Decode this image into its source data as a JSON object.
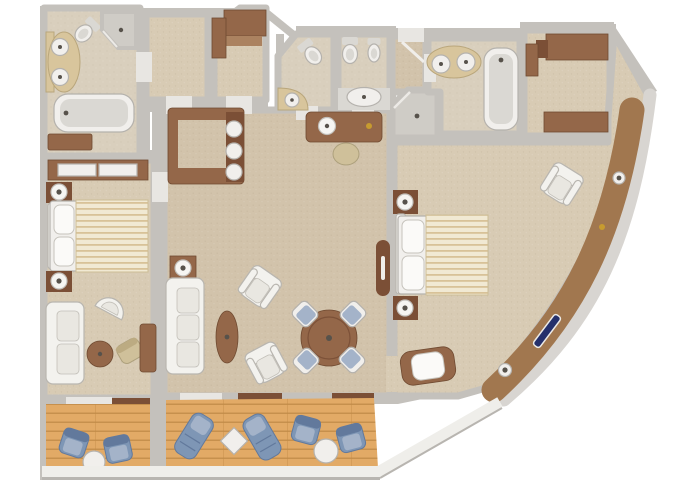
{
  "document": {
    "type": "floor-plan",
    "description": "Top-down 3D rendered floor plan of a two-bedroom ship suite with curved hull wall and two balconies",
    "visible_text": []
  },
  "colors": {
    "wall": "#c4c1bc",
    "hull": "#d8d5d1",
    "band": "#a1774f",
    "carpetLiving": "#d2c3ab",
    "carpetBedroom": "#d8cbb4",
    "bathFloor": "#d9cfbd",
    "showerTile": "#cfccc6",
    "deckWood": "#e2aa66",
    "deckLine": "#c08a47",
    "furnBrown": "#946749",
    "furnBrownDark": "#7b4f36",
    "furnBrownLight": "#ab8260",
    "counterTan": "#d8c59c",
    "fixtureWhite": "#f1efec",
    "fixtureInner": "#dad8d3",
    "fixtureEdge": "#b5b2ad",
    "sofaWhite": "#f3f2ee",
    "cushion": "#e9e7e1",
    "pillowWhite": "#fbfaf8",
    "duvetBase": "#f1e9d3",
    "duvetStripe": "#d8c298",
    "blue": "#7e96b5",
    "blueDark": "#62799c",
    "blueLight": "#a4b3c9",
    "windowNavy": "#25306b",
    "gold": "#c79b2f",
    "railing": "#efeeea",
    "lampWhite": "#f6f5f2",
    "stoolTan": "#cfc09a"
  },
  "rooms": [
    {
      "id": "master-bathroom",
      "fixtures": [
        "double-sink-vanity",
        "angled-toilet",
        "corner-shower",
        "bathtub",
        "storage-bench"
      ]
    },
    {
      "id": "wardrobe-room-a",
      "fixtures": []
    },
    {
      "id": "wardrobe-room-b",
      "fixtures": [
        "l-shaped-wardrobe"
      ]
    },
    {
      "id": "guest-toilet-1",
      "fixtures": [
        "angled-toilet",
        "corner-washbasin"
      ]
    },
    {
      "id": "guest-toilet-2",
      "fixtures": [
        "toilet",
        "bidet",
        "oval-washbasin"
      ]
    },
    {
      "id": "shower-room",
      "fixtures": [
        "corner-shower"
      ]
    },
    {
      "id": "second-bathroom",
      "fixtures": [
        "double-sink-vanity",
        "bathtub"
      ]
    },
    {
      "id": "walk-in-closet",
      "fixtures": [
        "wardrobe-top",
        "wardrobe-bottom",
        "side-cabinet"
      ]
    },
    {
      "id": "entry-hall",
      "fixtures": [
        "dressing-table",
        "stool",
        "entry-door"
      ]
    },
    {
      "id": "living-dining-room",
      "furniture": [
        "bar-counter-with-3-stools",
        "sofa",
        "lamp-table",
        "oval-coffee-table",
        "armchair",
        "armchair",
        "round-dining-table",
        "4-dining-chairs",
        "wall-console"
      ]
    },
    {
      "id": "master-bedroom",
      "furniture": [
        "wardrobe-with-sliding-doors",
        "nightstand-lamp",
        "double-bed-striped-duvet",
        "nightstand-lamp",
        "barrel-chair",
        "sofa",
        "round-side-table",
        "side-chair",
        "desk"
      ]
    },
    {
      "id": "second-bedroom",
      "furniture": [
        "nightstand-lamp",
        "double-bed-striped-duvet",
        "nightstand-lamp",
        "armchair",
        "cushioned-bench"
      ],
      "windows": [
        "porthole",
        "gold-fitting",
        "picture-window",
        "porthole"
      ]
    }
  ],
  "balconies": [
    {
      "id": "master-balcony",
      "furniture": [
        "deck-chair",
        "deck-chair",
        "round-table"
      ]
    },
    {
      "id": "living-balcony",
      "furniture": [
        "sun-lounger",
        "diamond-table",
        "sun-lounger",
        "deck-chair",
        "deck-chair",
        "round-table"
      ]
    }
  ]
}
